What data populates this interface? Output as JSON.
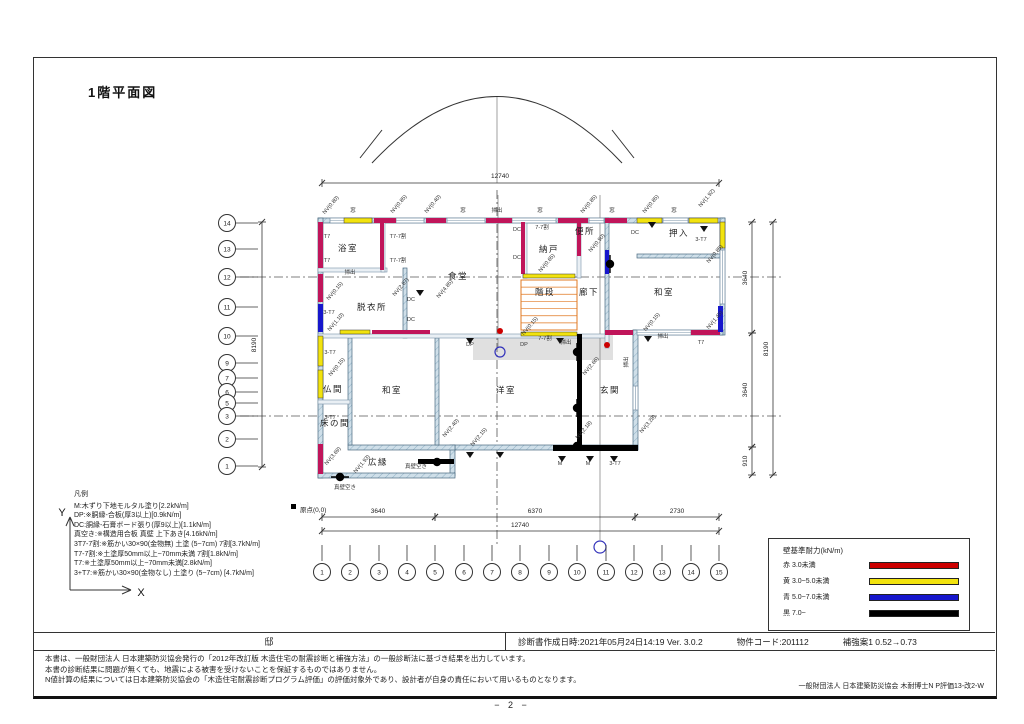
{
  "page": {
    "title": "1階平面図",
    "page_number": "− 2 −"
  },
  "info_bar": {
    "residence": "邸",
    "created": "診断書作成日時:2021年05月24日14:19  Ver. 3.0.2",
    "property_code": "物件コード:201112",
    "reinforcement": "補強案1 0.52→0.73"
  },
  "notes": [
    "本書は、一般財団法人 日本建築防災協会発行の「2012年改訂版 木造住宅の耐震診断と補強方法」の一般診断法に基づき結果を出力しています。",
    "本書の診断結果に問題が無くても、地震による被害を受けないことを保証するものではありません。",
    "N値計算の結果については日本建築防災協会の「木造住宅耐震診断プログラム評価」の評価対象外であり、設計者が自身の責任において用いるものとなります。"
  ],
  "credit": "一般財団法人  日本建築防災協会  木耐博士N  P評価13-改2-W",
  "legend_left": {
    "title": "凡例",
    "items": [
      "M:木ずり下地モルタル塗り[2.2kN/m]",
      "DP:※胴縁-合板(厚3以上)[0.9kN/m]",
      "DC:胴縁-石膏ボード張り(厚9以上)[1.1kN/m]",
      "真空き:※構造用合板 真壁 上下あき[4.16kN/m]",
      "3T7-7割:※筋かい30×90(金物無) 土塗 (5~7cm) 7割[3.7kN/m]",
      "T7-7割:※土塗厚50mm以上~70mm未満 7割[1.8kN/m]",
      "T7:※土塗厚50mm以上~70mm未満[2.8kN/m]",
      "3+T7:※筋かい30×90(金物なし) 土塗り (5~7cm) [4.7kN/m]"
    ]
  },
  "legend_right": {
    "title": "壁基準耐力(kN/m)",
    "items": [
      {
        "label": "赤  3.0未満",
        "color": "#cc0000"
      },
      {
        "label": "黄  3.0~5.0未満",
        "color": "#f2e30e"
      },
      {
        "label": "青  5.0~7.0未満",
        "color": "#1616cc"
      },
      {
        "label": "黒  7.0~",
        "color": "#000000"
      }
    ]
  },
  "plan": {
    "colors": {
      "crimson": "#c0155a",
      "yellow": "#f2e30e",
      "blue": "#1616cc",
      "black": "#000000",
      "orange": "#e07820"
    },
    "axis": {
      "x_label": "X",
      "y_label": "Y",
      "origin": "原点(0,0)"
    },
    "rooms": [
      [
        "浴室",
        348,
        251
      ],
      [
        "脱衣所",
        372,
        310
      ],
      [
        "食堂",
        458,
        279
      ],
      [
        "納戸",
        549,
        252
      ],
      [
        "便所",
        585,
        234
      ],
      [
        "押入",
        679,
        236
      ],
      [
        "階段",
        545,
        295
      ],
      [
        "廊下",
        589,
        295
      ],
      [
        "和室",
        664,
        295
      ],
      [
        "仏間",
        333,
        392
      ],
      [
        "和室",
        392,
        393
      ],
      [
        "洋室",
        506,
        393
      ],
      [
        "玄関",
        610,
        393
      ],
      [
        "床の間",
        335,
        426
      ],
      [
        "広縁",
        378,
        465
      ]
    ],
    "grid_left": [
      [
        "14",
        223
      ],
      [
        "13",
        249
      ],
      [
        "12",
        277
      ],
      [
        "11",
        307
      ],
      [
        "10",
        336
      ],
      [
        "9",
        363
      ],
      [
        "7",
        378
      ],
      [
        "6",
        392
      ],
      [
        "5",
        403
      ],
      [
        "3",
        416
      ],
      [
        "2",
        439
      ],
      [
        "1",
        466
      ]
    ],
    "grid_bottom": [
      [
        "1",
        322
      ],
      [
        "2",
        350
      ],
      [
        "3",
        379
      ],
      [
        "4",
        407
      ],
      [
        "5",
        435
      ],
      [
        "6",
        464
      ],
      [
        "7",
        492
      ],
      [
        "8",
        520
      ],
      [
        "9",
        549
      ],
      [
        "10",
        577
      ],
      [
        "11",
        606
      ],
      [
        "12",
        634
      ],
      [
        "13",
        662
      ],
      [
        "14",
        691
      ],
      [
        "15",
        719
      ]
    ],
    "dims_h": [
      [
        322,
        719,
        183,
        "12740",
        500,
        178
      ],
      [
        322,
        435,
        517,
        "3640",
        378,
        513
      ],
      [
        435,
        635,
        517,
        "6370",
        535,
        513
      ],
      [
        635,
        719,
        517,
        "2730",
        677,
        513
      ],
      [
        322,
        719,
        531,
        "12740",
        520,
        527
      ]
    ],
    "dims_v": [
      [
        222,
        467,
        262,
        "8190",
        256,
        345
      ],
      [
        222,
        333,
        752,
        "3640",
        747,
        278
      ],
      [
        333,
        447,
        752,
        "3640",
        747,
        390
      ],
      [
        447,
        475,
        752,
        "910",
        747,
        461
      ],
      [
        222,
        475,
        773,
        "8190",
        768,
        349
      ]
    ],
    "lines": [
      [
        240,
        277,
        782,
        277,
        1
      ],
      [
        240,
        416,
        782,
        416,
        1
      ],
      [
        497,
        190,
        497,
        545,
        1
      ],
      [
        497,
        97,
        497,
        183,
        0
      ],
      [
        600,
        195,
        600,
        540,
        0
      ],
      [
        498,
        195,
        498,
        348,
        0
      ]
    ],
    "arc": {
      "path": "M372,163 Q497,30 622,163",
      "slashes": [
        [
          382,
          130,
          360,
          158
        ],
        [
          612,
          130,
          634,
          158
        ]
      ]
    },
    "patches": [
      [
        473,
        334,
        140,
        26
      ]
    ],
    "walls": [
      [
        "e",
        318,
        218,
        407,
        5
      ],
      [
        "e",
        318,
        218,
        5,
        260
      ],
      [
        "e",
        720,
        218,
        5,
        117
      ],
      [
        "e",
        633,
        330,
        90,
        5
      ],
      [
        "e",
        633,
        330,
        5,
        120
      ],
      [
        "e",
        453,
        445,
        185,
        5
      ],
      [
        "e",
        450,
        445,
        5,
        31
      ],
      [
        "e",
        318,
        473,
        137,
        5
      ],
      [
        "e",
        348,
        445,
        107,
        5
      ],
      [
        "e",
        637,
        254,
        83,
        4
      ],
      [
        "e",
        605,
        218,
        4,
        116
      ],
      [
        "e",
        403,
        268,
        4,
        70
      ],
      [
        "e",
        435,
        338,
        4,
        107
      ],
      [
        "e",
        348,
        338,
        4,
        107
      ],
      [
        "p",
        318,
        268,
        69,
        4
      ],
      [
        "p",
        381,
        218,
        4,
        54
      ],
      [
        "p",
        523,
        218,
        4,
        60
      ],
      [
        "p",
        577,
        218,
        4,
        60
      ],
      [
        "p",
        318,
        334,
        290,
        4
      ],
      [
        "p",
        318,
        400,
        32,
        4
      ],
      [
        "p",
        605,
        334,
        4,
        14
      ],
      [
        "w",
        330,
        218,
        42,
        5
      ],
      [
        "w",
        396,
        218,
        28,
        5
      ],
      [
        "w",
        447,
        218,
        38,
        5
      ],
      [
        "w",
        512,
        218,
        44,
        5
      ],
      [
        "w",
        589,
        218,
        15,
        5
      ],
      [
        "w",
        663,
        218,
        25,
        5
      ],
      [
        "w",
        637,
        330,
        54,
        5
      ],
      [
        "w",
        720,
        250,
        5,
        54
      ],
      [
        "w",
        633,
        386,
        5,
        24
      ],
      [
        "c",
        374,
        218,
        22,
        5
      ],
      [
        "c",
        426,
        218,
        20,
        5
      ],
      [
        "c",
        486,
        218,
        26,
        5
      ],
      [
        "c",
        558,
        218,
        30,
        5
      ],
      [
        "c",
        605,
        218,
        22,
        5
      ],
      [
        "c",
        318,
        222,
        5,
        46
      ],
      [
        "c",
        318,
        274,
        5,
        28
      ],
      [
        "c",
        380,
        222,
        4,
        48
      ],
      [
        "c",
        521,
        222,
        4,
        52
      ],
      [
        "c",
        577,
        222,
        4,
        34
      ],
      [
        "c",
        605,
        330,
        28,
        5
      ],
      [
        "c",
        691,
        330,
        29,
        5
      ],
      [
        "c",
        318,
        444,
        5,
        30
      ],
      [
        "c",
        372,
        330,
        58,
        4
      ],
      [
        "y",
        344,
        218,
        28,
        5
      ],
      [
        "y",
        637,
        218,
        25,
        5
      ],
      [
        "y",
        689,
        218,
        29,
        5
      ],
      [
        "y",
        318,
        336,
        5,
        30
      ],
      [
        "y",
        318,
        370,
        5,
        28
      ],
      [
        "y",
        720,
        222,
        5,
        26
      ],
      [
        "y",
        523,
        274,
        52,
        4
      ],
      [
        "y",
        340,
        330,
        30,
        4
      ],
      [
        "y",
        521,
        332,
        56,
        4
      ],
      [
        "b",
        318,
        304,
        5,
        28
      ],
      [
        "b",
        605,
        250,
        4,
        24
      ],
      [
        "b",
        718,
        306,
        5,
        26
      ],
      [
        "k",
        577,
        334,
        5,
        112
      ],
      [
        "k",
        553,
        445,
        85,
        6
      ],
      [
        "k",
        418,
        459,
        36,
        5
      ]
    ],
    "stairs": [
      521,
      280,
      56,
      50
    ],
    "lens": [
      [
        577,
        352,
        "v"
      ],
      [
        577,
        408,
        "v"
      ],
      [
        577,
        446,
        "h"
      ],
      [
        437,
        462,
        "h"
      ],
      [
        340,
        477,
        "h"
      ],
      [
        610,
        264,
        "v"
      ]
    ],
    "dots_red": [
      [
        500,
        331
      ],
      [
        607,
        345
      ]
    ],
    "circles_blue": [
      [
        500,
        352,
        5
      ],
      [
        600,
        547,
        6
      ]
    ],
    "triangles": [
      [
        420,
        290
      ],
      [
        470,
        338
      ],
      [
        560,
        338
      ],
      [
        470,
        452
      ],
      [
        500,
        452
      ],
      [
        562,
        456
      ],
      [
        590,
        456
      ],
      [
        614,
        456
      ],
      [
        652,
        222
      ],
      [
        704,
        226
      ],
      [
        648,
        336
      ]
    ],
    "annotations": [
      [
        "NV(0.80)",
        332,
        206,
        -50
      ],
      [
        "窓",
        353,
        212,
        0
      ],
      [
        "NV(0.85)",
        400,
        205,
        -50
      ],
      [
        "NV(0.40)",
        434,
        205,
        -50
      ],
      [
        "窓",
        463,
        212,
        0
      ],
      [
        "掃出",
        497,
        212,
        0
      ],
      [
        "窓",
        540,
        212,
        0
      ],
      [
        "NV(0.85)",
        590,
        205,
        -50
      ],
      [
        "窓",
        612,
        212,
        0
      ],
      [
        "NV(0.85)",
        652,
        205,
        -50
      ],
      [
        "窓",
        674,
        212,
        0
      ],
      [
        "NV(1.92)",
        708,
        199,
        -50
      ],
      [
        "T7",
        327,
        238,
        0
      ],
      [
        "T7",
        327,
        262,
        0
      ],
      [
        "NV(0.15)",
        336,
        292,
        -50
      ],
      [
        "3-T7",
        329,
        314,
        0
      ],
      [
        "NV(1.10)",
        337,
        323,
        -50
      ],
      [
        "掃出",
        350,
        274,
        0
      ],
      [
        "T7-7割",
        398,
        238,
        0
      ],
      [
        "T7-7割",
        398,
        262,
        0
      ],
      [
        "NV(2.87)",
        402,
        288,
        -50
      ],
      [
        "NV(4.85)",
        446,
        290,
        -50
      ],
      [
        "DC",
        411,
        301,
        0
      ],
      [
        "DC",
        411,
        321,
        0
      ],
      [
        "DC",
        517,
        231,
        0
      ],
      [
        "DC",
        517,
        259,
        0
      ],
      [
        "7-7割",
        542,
        229,
        0
      ],
      [
        "NV(0.65)",
        548,
        264,
        -50
      ],
      [
        "NV(0.90)",
        598,
        244,
        -50
      ],
      [
        "3-T7",
        701,
        241,
        0
      ],
      [
        "NV(0.85)",
        716,
        255,
        -50
      ],
      [
        "NV(1.45)",
        716,
        321,
        -50
      ],
      [
        "NV(0.15)",
        653,
        323,
        -50
      ],
      [
        "掃出",
        663,
        338,
        0
      ],
      [
        "T7",
        701,
        344,
        0
      ],
      [
        "掃出",
        628,
        362,
        -90
      ],
      [
        "NV(2.66)",
        592,
        367,
        -50
      ],
      [
        "NV(0.15)",
        531,
        327,
        -50
      ],
      [
        "掃出",
        566,
        344,
        0
      ],
      [
        "DP",
        524,
        346,
        0
      ],
      [
        "3-T7",
        330,
        354,
        0
      ],
      [
        "NV(0.15)",
        338,
        368,
        -50
      ],
      [
        "3-T7",
        330,
        419,
        0
      ],
      [
        "NV(2.40)",
        452,
        429,
        -50
      ],
      [
        "NV(2.15)",
        480,
        438,
        -50
      ],
      [
        "NV(2.18)",
        585,
        431,
        -50
      ],
      [
        "NV(3.28)",
        649,
        425,
        -50
      ],
      [
        "NV(1.93)",
        363,
        465,
        -50
      ],
      [
        "NV(3.69)",
        334,
        457,
        -50
      ],
      [
        "真壁空き",
        345,
        489,
        0
      ],
      [
        "真壁空き",
        416,
        468,
        0
      ],
      [
        "M",
        560,
        465,
        0
      ],
      [
        "M",
        588,
        465,
        0
      ],
      [
        "3-T7",
        615,
        465,
        0
      ],
      [
        "DP",
        470,
        346,
        0
      ],
      [
        "7-7割",
        545,
        340,
        0
      ],
      [
        "DC",
        635,
        234,
        0
      ]
    ]
  }
}
